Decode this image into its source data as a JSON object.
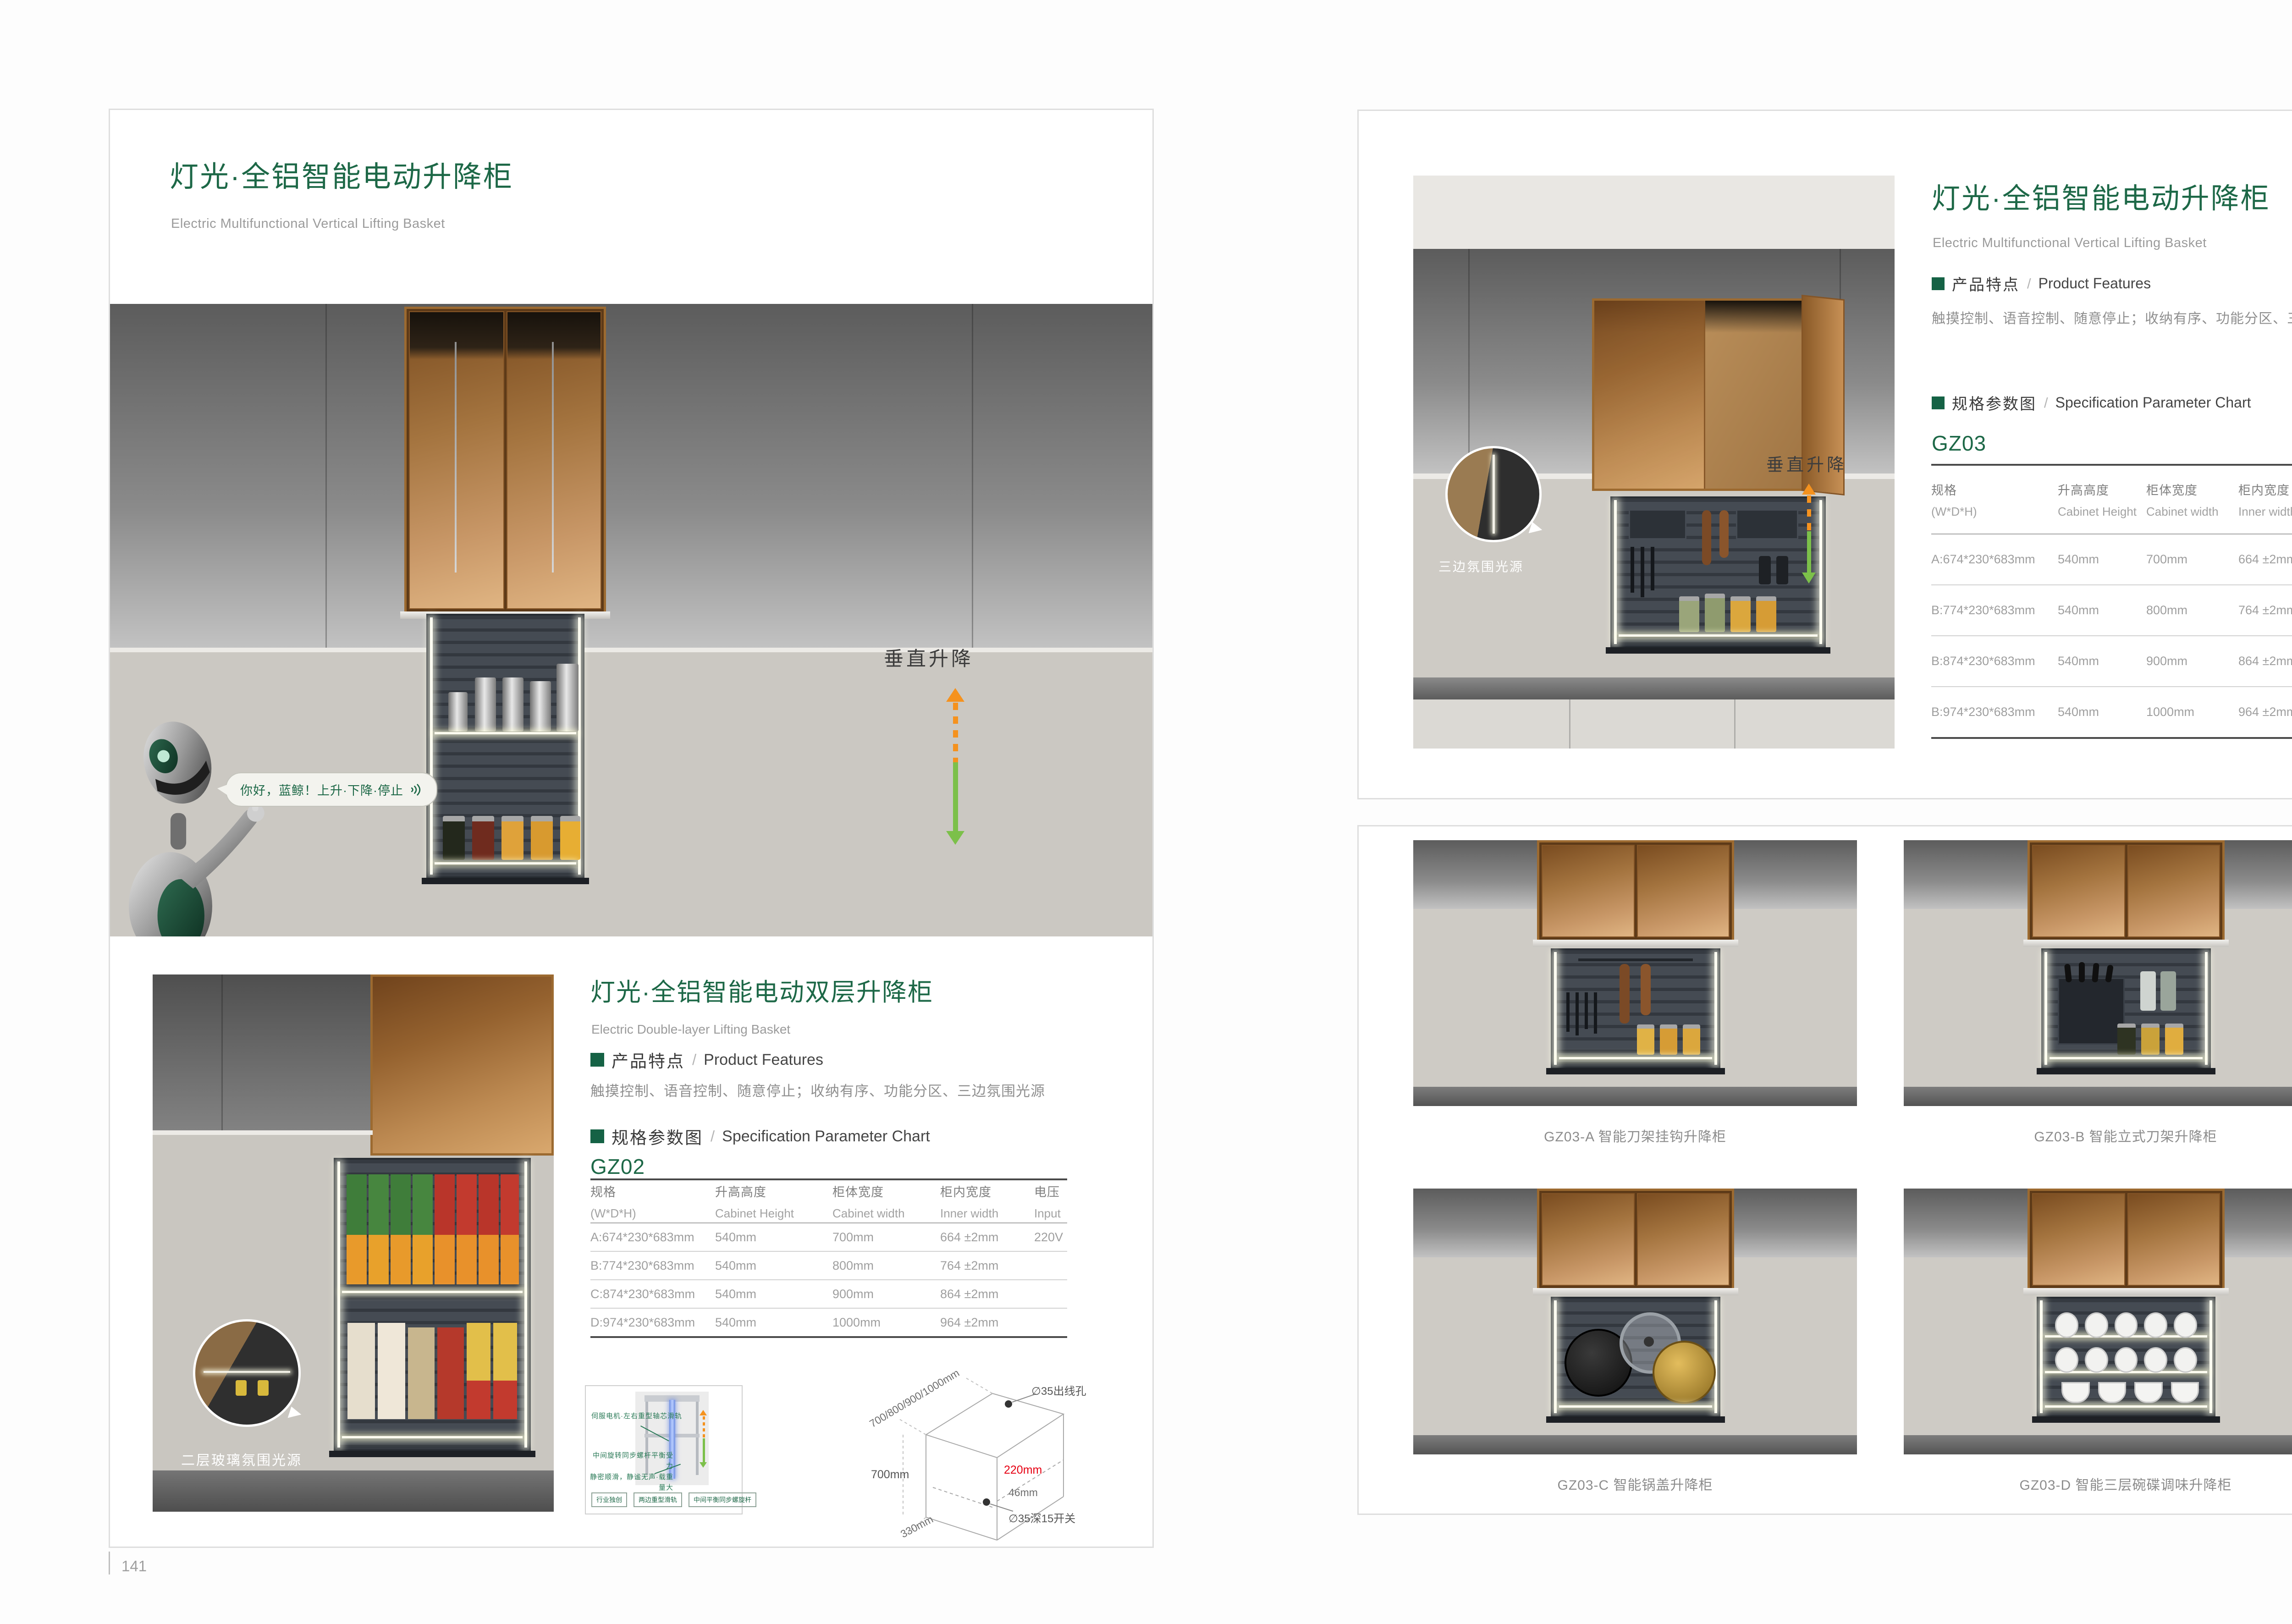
{
  "colors": {
    "brand_green": "#1d6847",
    "arrow_orange": "#f5921e",
    "arrow_green": "#7cc04a",
    "dimension_red": "#e60012"
  },
  "sections": {
    "features_zh": "产品特点",
    "features_en": "Product Features",
    "spec_zh": "规格参数图",
    "spec_en": "Specification Parameter Chart",
    "slash": "/",
    "features_text": "触摸控制、语音控制、随意停止；收纳有序、功能分区、三边氛围光源"
  },
  "tables": {
    "headers": [
      {
        "zh": "规格",
        "en": "(W*D*H)"
      },
      {
        "zh": "升高高度",
        "en": "Cabinet Height"
      },
      {
        "zh": "柜体宽度",
        "en": "Cabinet width"
      },
      {
        "zh": "柜内宽度",
        "en": "Inner width"
      },
      {
        "zh": "电压",
        "en": "Input"
      }
    ],
    "gz02": {
      "model": "GZ02",
      "rows": [
        [
          "A:674*230*683mm",
          "540mm",
          "700mm",
          "664 ±2mm",
          "220V"
        ],
        [
          "B:774*230*683mm",
          "540mm",
          "800mm",
          "764 ±2mm",
          ""
        ],
        [
          "C:874*230*683mm",
          "540mm",
          "900mm",
          "864 ±2mm",
          ""
        ],
        [
          "D:974*230*683mm",
          "540mm",
          "1000mm",
          "964 ±2mm",
          ""
        ]
      ]
    },
    "gz03": {
      "model": "GZ03",
      "rows": [
        [
          "A:674*230*683mm",
          "540mm",
          "700mm",
          "664 ±2mm",
          "220V"
        ],
        [
          "B:774*230*683mm",
          "540mm",
          "800mm",
          "764 ±2mm",
          ""
        ],
        [
          "B:874*230*683mm",
          "540mm",
          "900mm",
          "864 ±2mm",
          ""
        ],
        [
          "B:974*230*683mm",
          "540mm",
          "1000mm",
          "964 ±2mm",
          ""
        ]
      ]
    }
  },
  "page_left": {
    "page_number": "141",
    "title": "灯光·全铝智能电动升降柜",
    "subtitle": "Electric Multifunctional Vertical Lifting Basket",
    "hero": {
      "speech": "你好，蓝鲸！上升·下降·停止",
      "motion_label": "垂直升降"
    },
    "lower": {
      "title": "灯光·全铝智能电动双层升降柜",
      "subtitle": "Electric Double-layer Lifting Basket",
      "photo_callout": "二层玻璃氛围光源",
      "diagram": {
        "note1": "伺服电机·左右重型轴芯滑轨",
        "note2": "中间旋转同步螺杆平衡受力",
        "note3": "静密顺滑，静谧无声·载重量大",
        "tags": [
          "行业独创",
          "两边重型滑轨",
          "中间平衡同步螺旋杆"
        ]
      },
      "iso": {
        "width_options": "700/800/900/1000mm",
        "outlet_hole": "∅35出线孔",
        "height": "700mm",
        "inner_height": "220mm",
        "offset": "46mm",
        "switch": "∅35深15开关",
        "depth": "330mm"
      }
    }
  },
  "page_right": {
    "page_number": "142",
    "title": "灯光·全铝智能电动升降柜",
    "subtitle": "Electric Multifunctional Vertical Lifting Basket",
    "photo_callout": "三边氛围光源",
    "motion_label": "垂直升降",
    "grid_captions": [
      "GZ03-A 智能刀架挂钩升降柜",
      "GZ03-B 智能立式刀架升降柜",
      "GZ03-C 智能锅盖升降柜",
      "GZ03-D 智能三层碗碟调味升降柜"
    ]
  }
}
